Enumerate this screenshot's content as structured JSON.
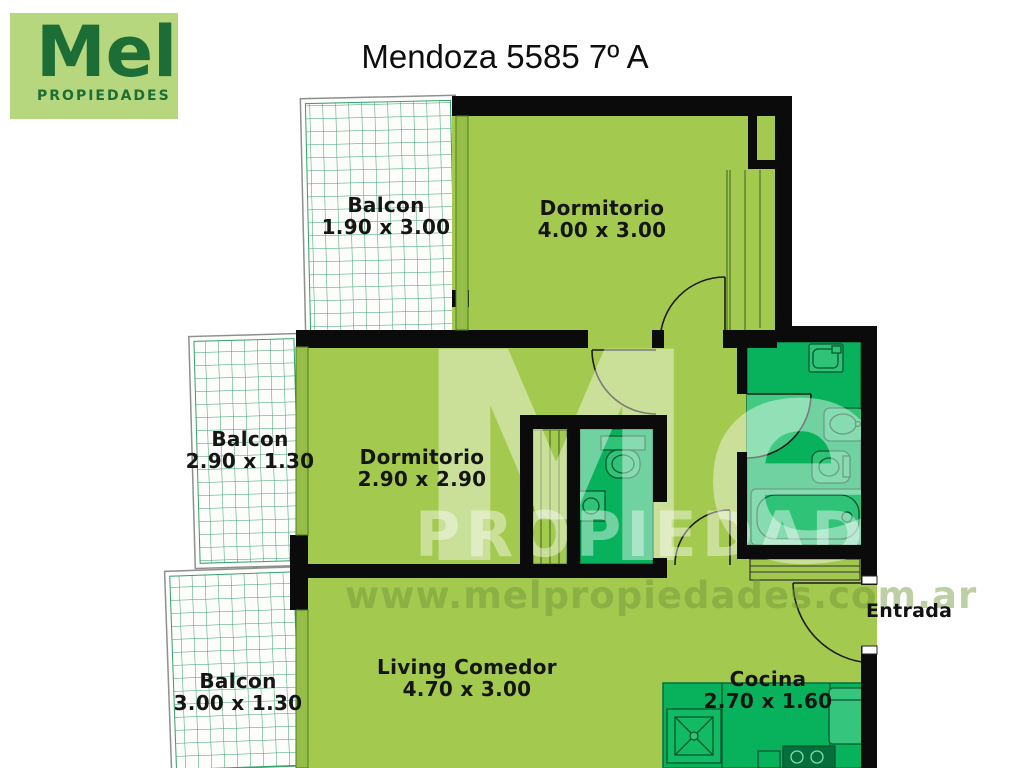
{
  "logo": {
    "name": "Mel",
    "subtitle": "PROPIEDADES"
  },
  "title": "Mendoza 5585 7º A",
  "rooms": [
    {
      "name": "Balcon",
      "dims": "1.90 x 3.00"
    },
    {
      "name": "Dormitorio",
      "dims": "4.00 x 3.00"
    },
    {
      "name": "Balcon",
      "dims": "2.90 x 1.30"
    },
    {
      "name": "Dormitorio",
      "dims": "2.90 x 2.90"
    },
    {
      "name": "Balcon",
      "dims": "3.00 x 1.30"
    },
    {
      "name": "Living Comedor",
      "dims": "4.70 x 3.00"
    },
    {
      "name": "Cocina",
      "dims": "2.70 x 1.60"
    }
  ],
  "entrance_label": "Entrada",
  "watermark": {
    "brand": "Mel",
    "brand_sub": "PROPIEDADES",
    "website": "www.melpropiedades.com.ar"
  },
  "fixtures": [
    "bathtub",
    "toilet",
    "bidet",
    "sink",
    "wardrobe",
    "entry-closet",
    "kitchen-sink",
    "stove",
    "fridge"
  ],
  "colors": {
    "wall": "#0b0b0b",
    "floor": "#a4c94f",
    "wet_area": "#08b15c",
    "balcony_grid": "#35a06c",
    "logo_bg": "#b6d77d",
    "logo_text": "#1c6d36"
  }
}
